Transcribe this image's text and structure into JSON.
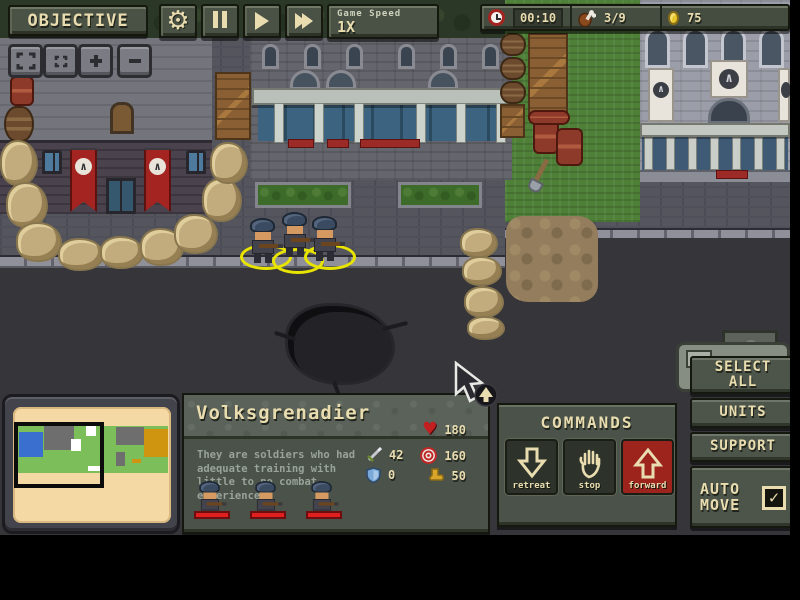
{
  "hud": {
    "objective_label": "OBJECTIVE",
    "game_speed_label": "Game Speed",
    "game_speed_value": "1X",
    "timer": "00:10",
    "supply_count": "3/9",
    "gold_count": "75"
  },
  "unit_panel": {
    "name": "Volksgrenadier",
    "description": "They are soldiers who had adequate training with little to no combat experience",
    "stats": {
      "hp": "180",
      "attack": "42",
      "range": "160",
      "armor": "0",
      "cost": "50"
    }
  },
  "commands_panel": {
    "title": "COMMANDS",
    "retreat_label": "retreat",
    "stop_label": "stop",
    "forward_label": "forward"
  },
  "side_panel": {
    "select_all_label": "SELECT ALL",
    "units_label": "UNITS",
    "support_label": "SUPPORT",
    "auto_move_label": "AUTO MOVE",
    "auto_move_checked": "✓"
  },
  "banners": {
    "axis_emblem": "∧"
  },
  "colors": {
    "ui_green": "#4a5246",
    "cream_text": "#e9ddb0",
    "forward_red": "#9c241c",
    "heart_red": "#c22020",
    "coin_gold": "#e8c62e",
    "selection_yellow": "#e8e400",
    "banner_red": "#a32420"
  }
}
